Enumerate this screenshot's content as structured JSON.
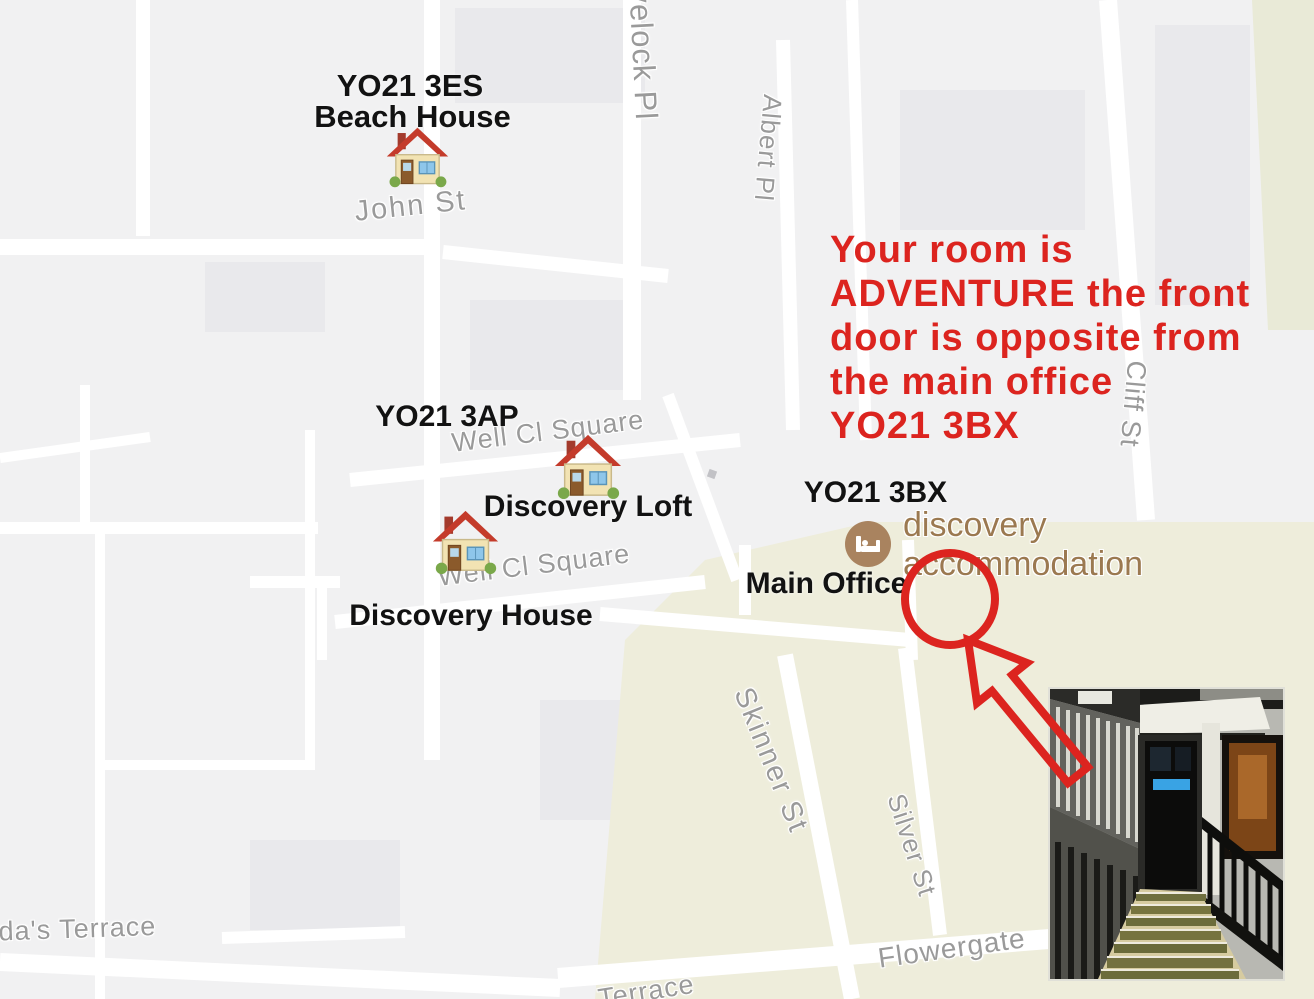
{
  "title": "Annotated accommodation map",
  "colors": {
    "annotation_red": "#dc241f",
    "annotation_black": "#121212",
    "street_gray": "#9a9a9a",
    "poi_brown": "#9b7950",
    "poi_icon_bg": "#a9835f",
    "map_bg": "#f1f1f2",
    "map_commercial": "#eeeddb",
    "road_white": "#ffffff"
  },
  "note": {
    "lines": [
      "Your room is",
      "ADVENTURE the front",
      "door is opposite from",
      "the main office",
      "YO21 3BX"
    ]
  },
  "markers": {
    "beach_house": {
      "postcode": "YO21 3ES",
      "name": "Beach House",
      "icon": "house-icon"
    },
    "discovery_loft": {
      "postcode": "YO21 3AP",
      "name": "Discovery Loft",
      "icon": "house-icon"
    },
    "discovery_house": {
      "name": "Discovery House",
      "icon": "house-icon"
    },
    "main_office": {
      "postcode": "YO21 3BX",
      "name": "Main Office"
    }
  },
  "poi": {
    "line1": "discovery",
    "line2": "accommodation",
    "icon": "lodging-bed-icon"
  },
  "streets": [
    {
      "label": "Havelock Pl"
    },
    {
      "label": "Albert Pl"
    },
    {
      "label": "John St"
    },
    {
      "label": "Well Cl Square"
    },
    {
      "label": "Well Cl Square"
    },
    {
      "label": "Cliff St"
    },
    {
      "label": "Skinner St"
    },
    {
      "label": "Silver St"
    },
    {
      "label": "Flowergate"
    },
    {
      "label": "ilda's Terrace"
    },
    {
      "label": "Terrace"
    }
  ],
  "photo": {
    "name": "entrance-photo"
  }
}
